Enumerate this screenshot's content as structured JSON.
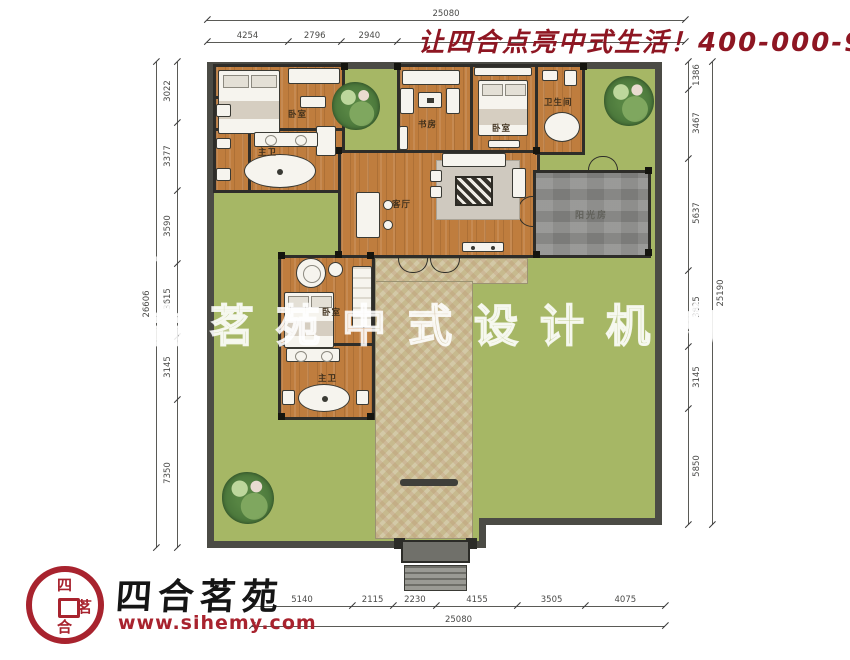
{
  "header": {
    "slogan": "让四合点亮中式生活！400-000-9075",
    "color": "#8e1622"
  },
  "watermark": {
    "text": "四合茗苑中式设计机构"
  },
  "logo": {
    "brand": "四合茗苑",
    "website": "www.sihemy.com",
    "seal_chars": [
      "四",
      "茗",
      "合"
    ],
    "seal_color": "#a8232e"
  },
  "plan": {
    "room_labels": {
      "bedroom_nw": "卧室",
      "bath_nw": "主卫",
      "study": "书房",
      "bedroom_n": "卧室",
      "bath_ne": "卫生间",
      "living": "客厅",
      "sunroom": "阳光房",
      "bedroom_w": "卧室",
      "bath_w": "主卫"
    },
    "colors": {
      "lawn": "#a6b765",
      "wall": "#4b4b45",
      "wood_floor": "#bf7d3e",
      "sunroom_floor": "#8c8c8a",
      "path": "#c7ba8e"
    }
  },
  "dimensions": {
    "top": {
      "total": "25080",
      "segments": [
        "4254",
        "2796",
        "2940"
      ]
    },
    "bottom": {
      "total": "25080",
      "segments": [
        "5140",
        "2115",
        "2230",
        "4155",
        "3505",
        "4075"
      ]
    },
    "left": {
      "total": "26606",
      "segments": [
        "3022",
        "3377",
        "3590",
        "3615",
        "3145",
        "7350"
      ]
    },
    "right": {
      "total": "25190",
      "segments": [
        "1386",
        "3467",
        "5637",
        "3825",
        "3145",
        "5850"
      ]
    }
  }
}
